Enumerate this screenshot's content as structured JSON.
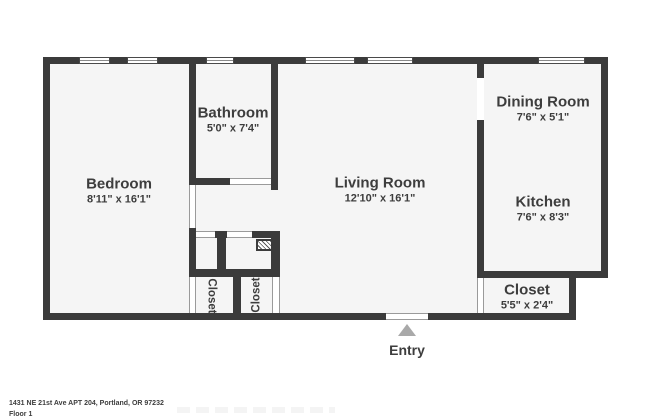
{
  "plan": {
    "rooms": [
      {
        "name": "Bedroom",
        "dims": "8'11\" x 16'1\""
      },
      {
        "name": "Bathroom",
        "dims": "5'0\" x 7'4\""
      },
      {
        "name": "Living Room",
        "dims": "12'10\" x 16'1\""
      },
      {
        "name": "Dining Room",
        "dims": "7'6\" x 5'1\""
      },
      {
        "name": "Kitchen",
        "dims": "7'6\" x 8'3\""
      },
      {
        "name": "Closet",
        "dims": "5'5\" x 2'4\""
      },
      {
        "name": "Closet"
      },
      {
        "name": "Closet"
      }
    ],
    "entry_label": "Entry",
    "icons": {
      "entry_arrow": "triangle-up-icon",
      "utility_hatch": "hatched-fixture"
    },
    "colors": {
      "wall": "#3b3b3b",
      "floor": "#f5f5f5",
      "bg": "#ffffff",
      "text": "#3d3d3d",
      "arrow": "#a9a9a9"
    }
  },
  "footer": {
    "address": "1431 NE 21st Ave APT 204, Portland, OR 97232",
    "floor_label": "Floor 1"
  }
}
